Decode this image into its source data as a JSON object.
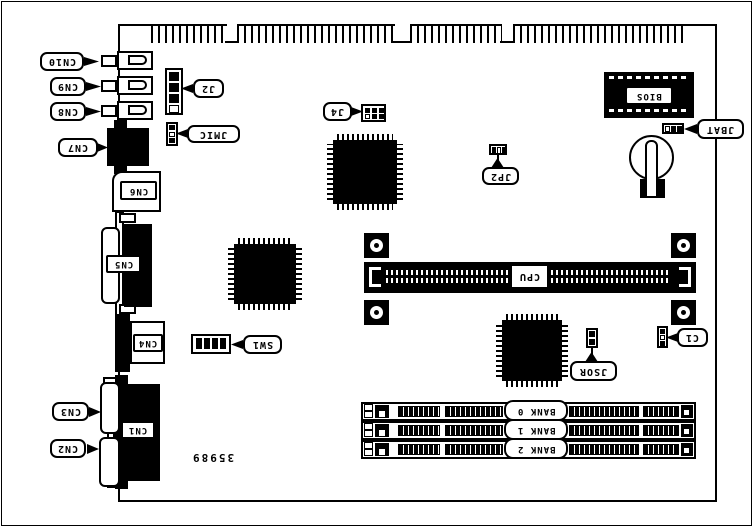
{
  "diagram": {
    "part_number": "35989",
    "callouts": {
      "cn10": "CN10",
      "cn9": "CN9",
      "cn8": "CN8",
      "cn7": "CN7",
      "cn6": "CN6",
      "cn5": "CN5",
      "cn4": "CN4",
      "cn3": "CN3",
      "cn2": "CN2",
      "cn1": "CN1",
      "j2": "J2",
      "jmic": "JMIC",
      "j4": "J4",
      "jp2": "JP2",
      "jbat": "JBAT",
      "sw1": "SW1",
      "jsor": "JSOR",
      "c1": "C1"
    },
    "chips": {
      "bios": "BIOS",
      "cpu": "CPU"
    },
    "banks": [
      {
        "label": "BANK 0"
      },
      {
        "label": "BANK 1"
      },
      {
        "label": "BANK 2"
      }
    ]
  }
}
